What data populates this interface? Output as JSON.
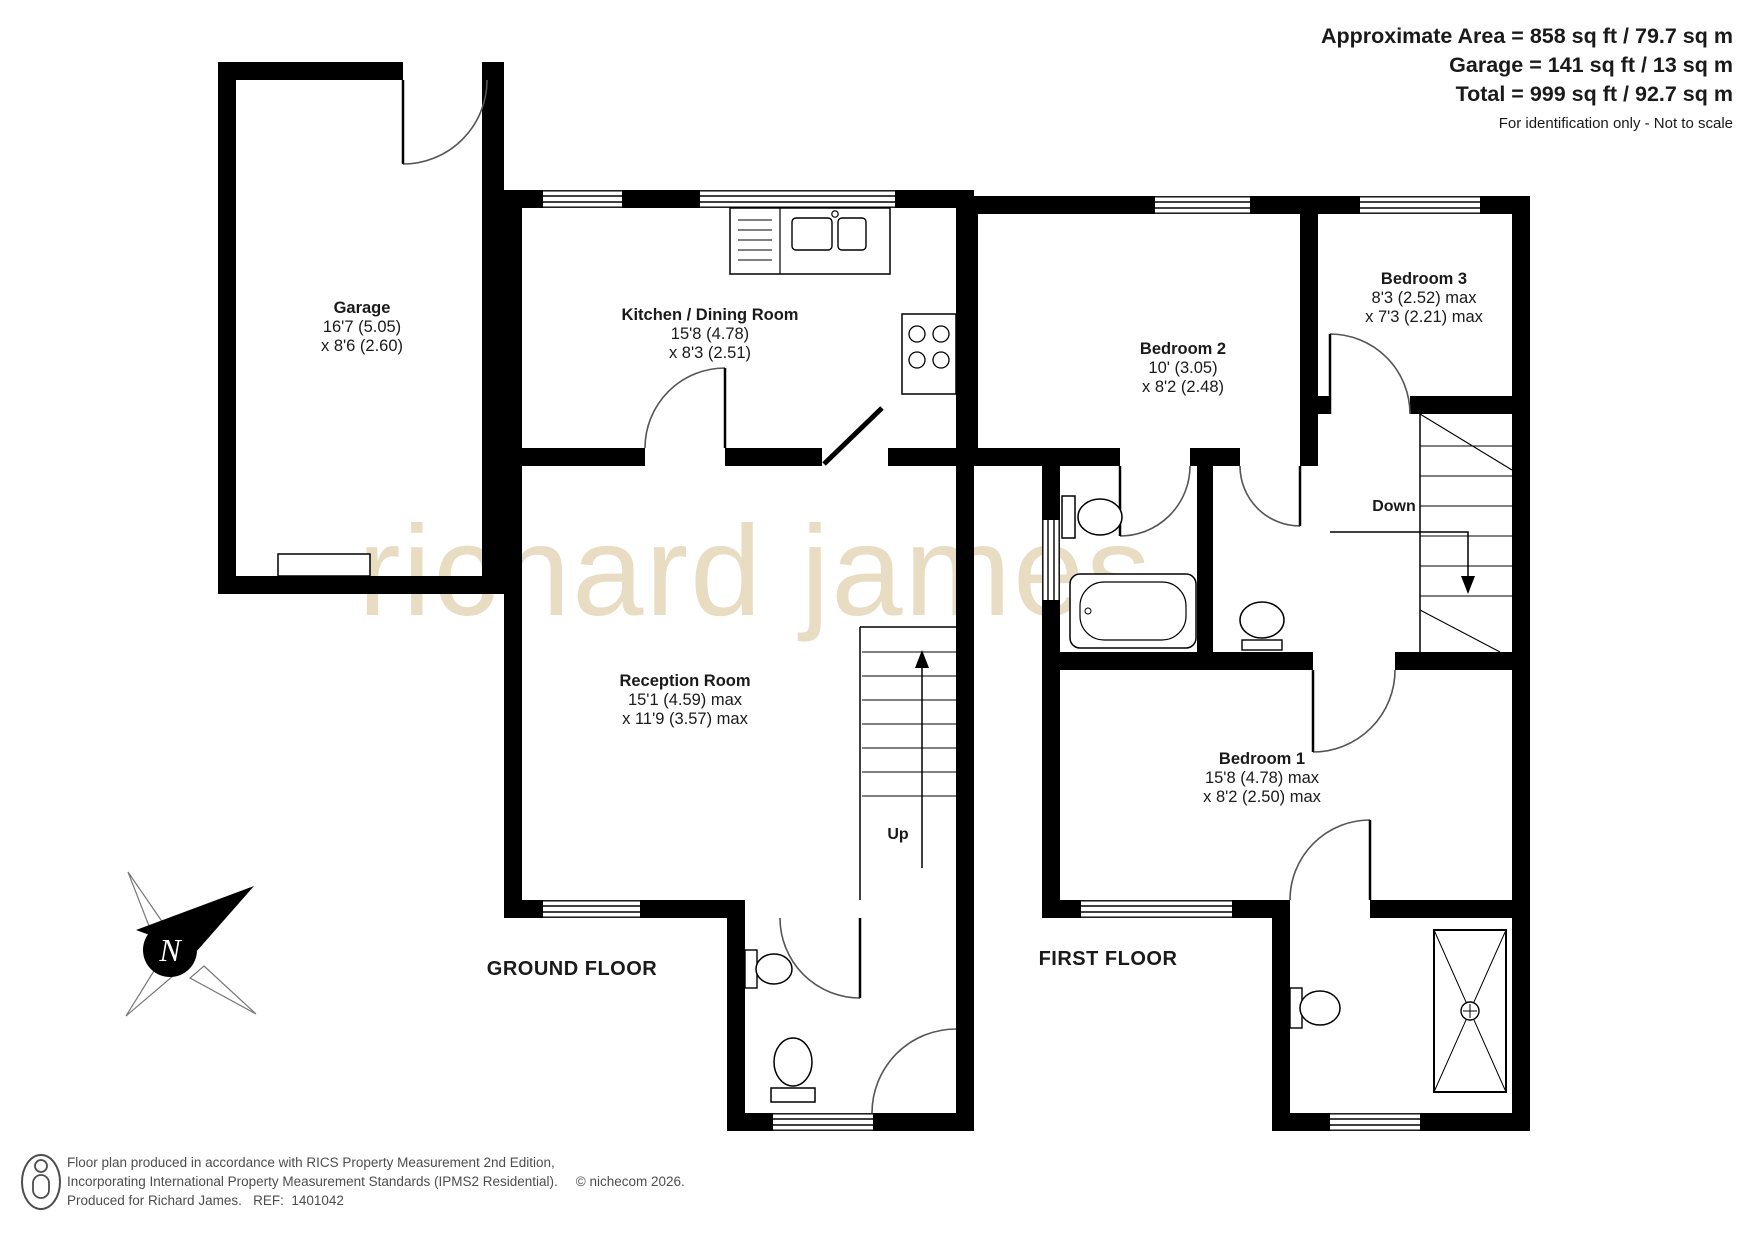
{
  "header": {
    "line1": "Approximate Area = 858 sq ft / 79.7 sq m",
    "line2": "Garage = 141 sq ft / 13 sq m",
    "line3": "Total = 999 sq ft / 92.7 sq m",
    "note": "For identification only - Not to scale"
  },
  "watermark": "richard james",
  "rooms": {
    "garage": {
      "name": "Garage",
      "dim1": "16'7 (5.05)",
      "dim2": "x 8'6 (2.60)"
    },
    "kitchen": {
      "name": "Kitchen / Dining Room",
      "dim1": "15'8 (4.78)",
      "dim2": "x 8'3 (2.51)"
    },
    "reception": {
      "name": "Reception Room",
      "dim1": "15'1 (4.59) max",
      "dim2": "x 11'9 (3.57) max"
    },
    "bedroom2": {
      "name": "Bedroom 2",
      "dim1": "10' (3.05)",
      "dim2": "x 8'2 (2.48)"
    },
    "bedroom3": {
      "name": "Bedroom 3",
      "dim1": "8'3 (2.52) max",
      "dim2": "x 7'3 (2.21) max"
    },
    "bedroom1": {
      "name": "Bedroom 1",
      "dim1": "15'8 (4.78) max",
      "dim2": "x 8'2 (2.50) max"
    }
  },
  "stairs": {
    "up": "Up",
    "down": "Down"
  },
  "floor_labels": {
    "ground": "GROUND FLOOR",
    "first": "FIRST FLOOR"
  },
  "compass": {
    "north": "N"
  },
  "footer": {
    "line1": "Floor plan produced in accordance with RICS Property Measurement 2nd Edition,",
    "line2": "Incorporating International Property Measurement Standards (IPMS2 Residential).",
    "copyright": "© nichecom 2026.",
    "line3": "Produced for Richard James.   REF:  1401042"
  },
  "colors": {
    "wall": "#000000",
    "watermark": "#e8dcc2",
    "footer_text": "#4d4d4d"
  }
}
